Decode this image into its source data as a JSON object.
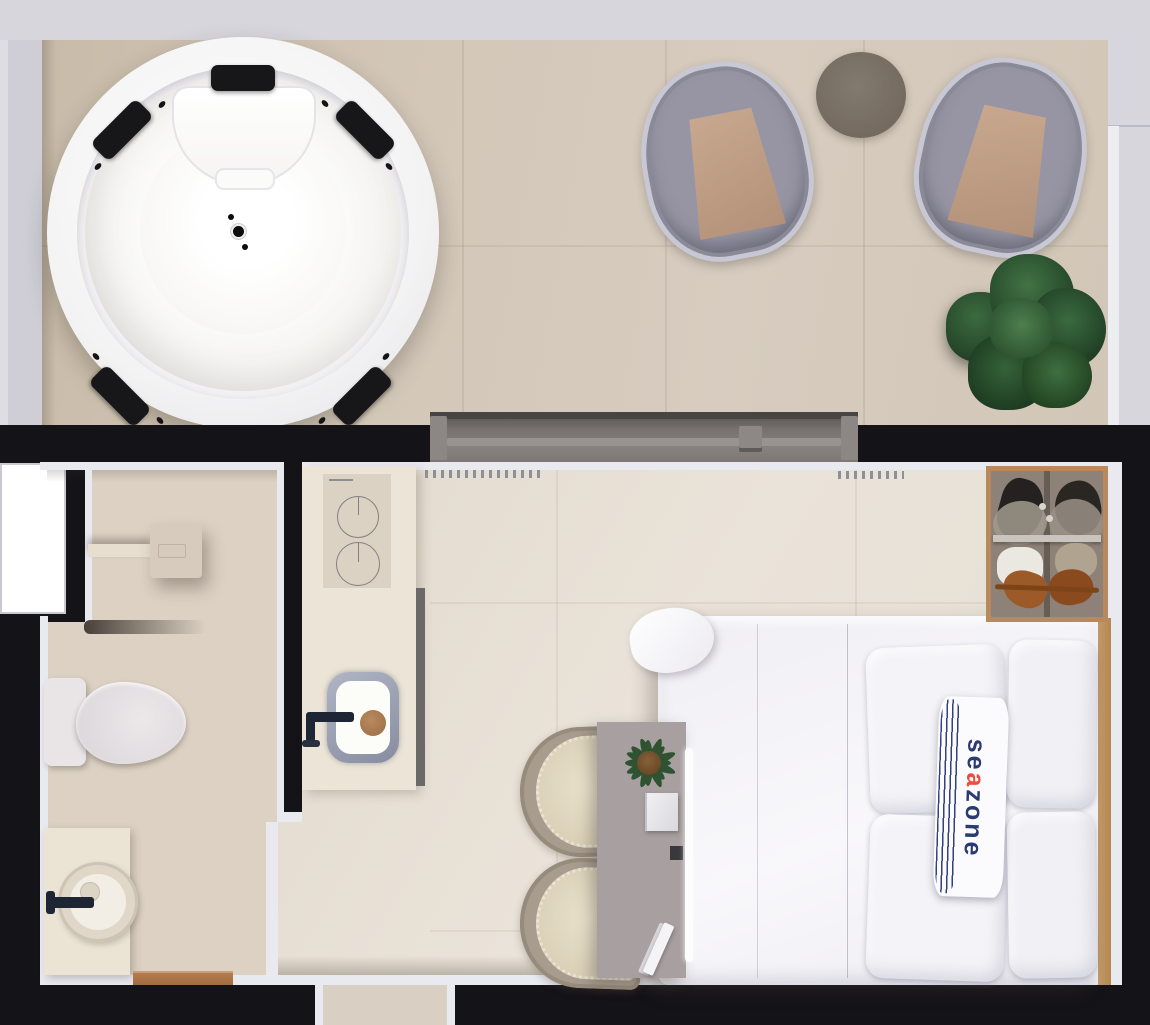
{
  "scene": {
    "kind": "3d-rendered floor plan, top-down view",
    "rooms": [
      "terrace",
      "bathroom",
      "kitchenette",
      "bedroom",
      "entry-corridor"
    ],
    "terrace": {
      "objects": [
        "round-jacuzzi",
        "wicker-armchair-left",
        "wicker-armchair-right",
        "round-side-table",
        "potted-plant"
      ],
      "jacuzzi_headrests": 5
    },
    "bathroom": {
      "objects": [
        "rain-shower-head",
        "shower-shelf",
        "toilet",
        "vanity-with-round-basin",
        "wood-door-threshold"
      ]
    },
    "kitchenette": {
      "objects": [
        "two-burner-cooktop",
        "counter",
        "square-sink-with-round-board",
        "faucet",
        "tall-cabinet"
      ]
    },
    "bedroom": {
      "objects": [
        "double-bed",
        "four-pillows",
        "branded-bed-runner",
        "wood-headboard",
        "open-closet-with-clothes",
        "desk",
        "desk-plant",
        "laptop",
        "two-rattan-chairs",
        "sliding-glass-door",
        "curtains"
      ]
    }
  },
  "runner": {
    "full_text": "seazone",
    "part1": "se",
    "part2": "a",
    "part3": "zone"
  },
  "palette": {
    "wall_black": "#141318",
    "outer_gray": "#d7d6dc",
    "terrace_floor": "#d3c7b8",
    "interior_floor": "#e8e1d6",
    "bathroom_floor": "#dcd1c3",
    "wall_face_white": "#e9eaf0",
    "door_gray": "#76716e",
    "cushion_tan": "#c2a189",
    "plant_green": "#2e5434",
    "wood": "#b9895e",
    "brand_navy": "#2c3a72",
    "brand_red": "#ef4b3e"
  }
}
